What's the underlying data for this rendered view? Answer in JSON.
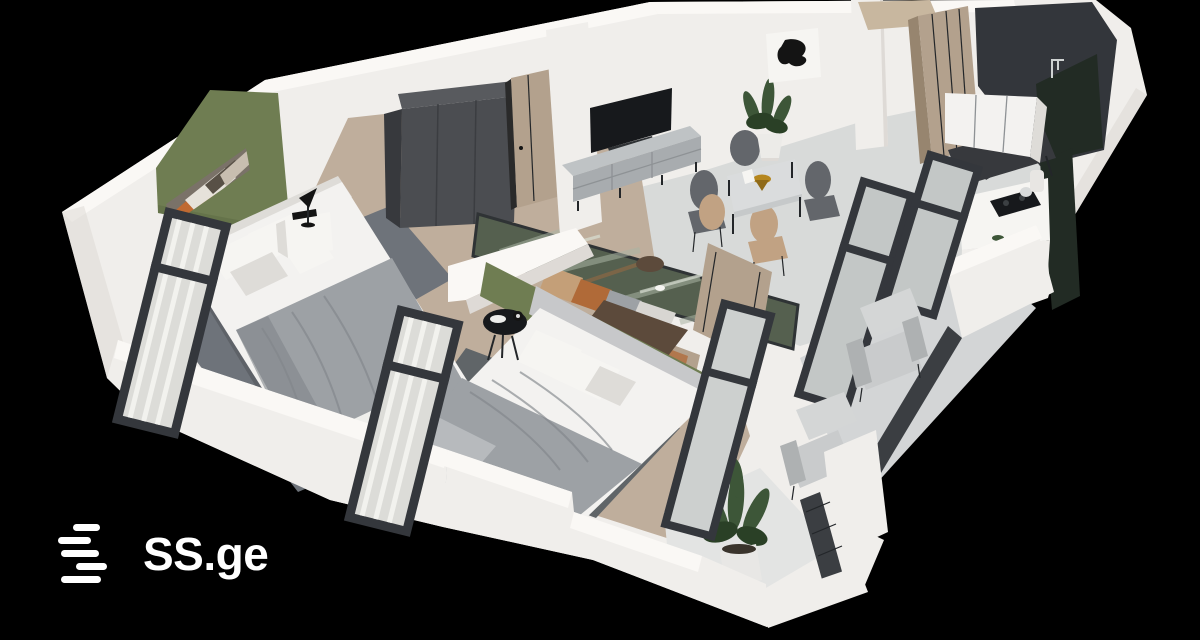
{
  "brand": {
    "logo_text": "SS.ge"
  },
  "scene": {
    "type": "isometric-3d-floorplan-render",
    "rooms": [
      "bedroom-1",
      "living-room",
      "dining-area",
      "kitchen",
      "hallway",
      "bedroom-2",
      "balcony",
      "lower-balcony"
    ],
    "furniture": [
      "double-bed",
      "wardrobe",
      "wall-tv",
      "tv-console",
      "dining-table-with-chairs",
      "sofa",
      "mirror-panel",
      "coffee-table",
      "kitchen-cabinet",
      "cooktop-counter",
      "outdoor-armchairs",
      "potted-plants",
      "floor-to-ceiling-windows",
      "wood-doors",
      "nightstands",
      "table-lamp",
      "wall-art"
    ]
  },
  "colors": {
    "bg": "#000000",
    "logo": "#FFFFFF",
    "wall": "#F0EEEB",
    "wall_bright": "#FAF8F5",
    "wall_shade": "#DEDAD6",
    "wall_dark": "#C9C5C0",
    "floor_living": "#D8DAD9",
    "floor_light": "#E3E4E3",
    "carpet_tan": "#BFAE9C",
    "carpet_dark": "#A5917E",
    "rug_b1": "#6E737A",
    "rug_b2": "#606568",
    "green": "#6F7D52",
    "green_dark": "#5C6942",
    "frame": "#34373C",
    "frame_dark": "#232629",
    "curtain": "#DCDCD8",
    "glass": "#C3C7C6",
    "wood": "#B3A18D",
    "wood_dark": "#97856F",
    "wood_light": "#C8B79F",
    "charcoal": "#4B4D51",
    "charcoal_dark": "#37393D",
    "charcoal_top": "#585A5E",
    "tv": "#17191C",
    "console": "#A8ACAF",
    "console_light": "#BFC3C5",
    "blanket": "#9DA1A5",
    "blanket_dark": "#81858A",
    "bed": "#F3F2F0",
    "bed_shade": "#DEDCD8",
    "marble": "#DADCDD",
    "gold": "#B5861E",
    "chair_dark": "#63666B",
    "chair_wood": "#C1A283",
    "plant": "#3D5638",
    "plant_dark": "#2A4026",
    "mirror": "#55604F",
    "sofa_tan": "#C49F78",
    "sofa_rust": "#B06A38",
    "coffee": "#5C4A3B",
    "kitchen": "#33363B",
    "kitchen_glass": "#222B24",
    "balcony": "#D3D5D6",
    "rail": "#3B3E42"
  }
}
